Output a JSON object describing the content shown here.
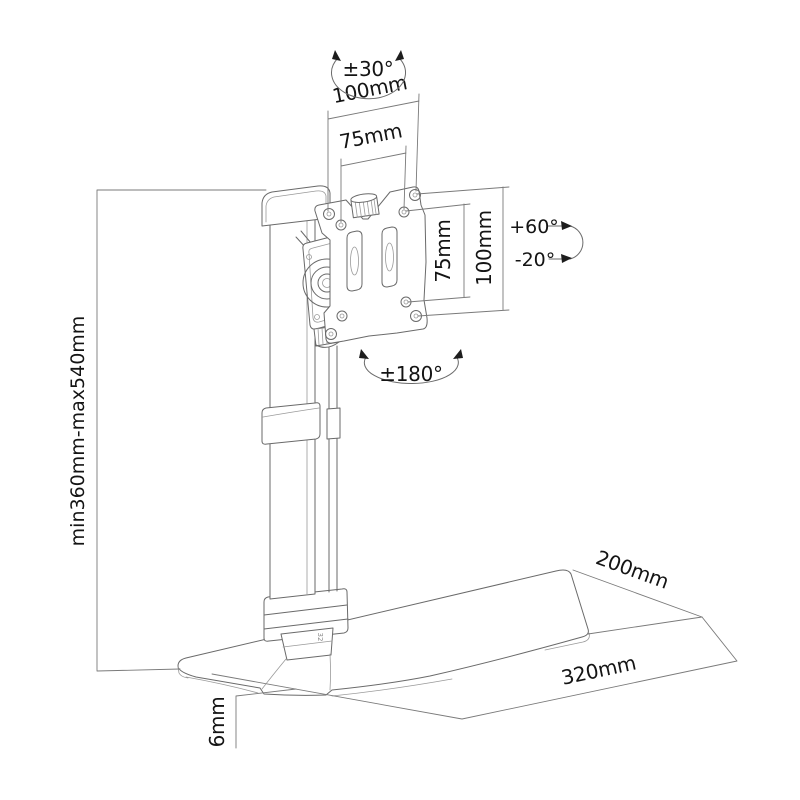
{
  "diagram": {
    "type": "technical-line-drawing",
    "subject": "desk monitor stand with VESA plate - dimension diagram",
    "labels": {
      "swivel_angle": "±30°",
      "vesa_outer_width": "100mm",
      "vesa_inner_width": "75mm",
      "vesa_inner_height": "75mm",
      "vesa_outer_height": "100mm",
      "tilt_up": "+60°",
      "tilt_down": "-20°",
      "rotation": "±180°",
      "height_range": "min360mm-max540mm",
      "base_depth": "200mm",
      "base_width": "320mm",
      "base_thickness": "6mm",
      "foot_marking": "32"
    },
    "colors": {
      "background": "#ffffff",
      "line": "#6a6a6a",
      "text": "#141414"
    }
  }
}
